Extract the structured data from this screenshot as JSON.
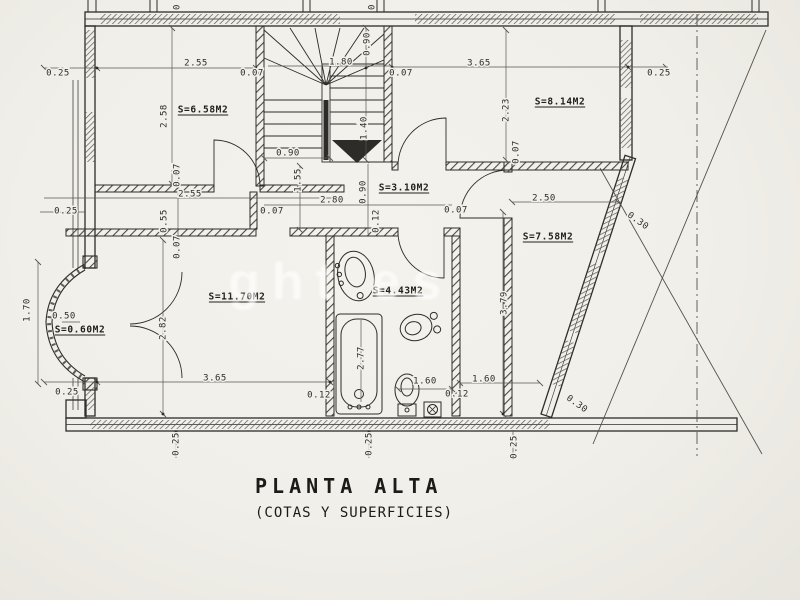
{
  "document": {
    "title": "PLANTA ALTA",
    "subtitle": "(COTAS Y SUPERFICIES)",
    "watermark_text": "ght es"
  },
  "colors": {
    "paper": "#f2f0ea",
    "ink": "#2e2c28",
    "dim_line": "#5a5751",
    "watermark": "#ffffff"
  },
  "room_area_labels": [
    "S=6.58M2",
    "S=8.14M2",
    "S=3.10M2",
    "S=7.58M2",
    "S=11.70M2",
    "S=4.43M2",
    "S=0.60M2"
  ],
  "plan": {
    "labels": [
      {
        "t": "0.25",
        "x": 58,
        "y": 73
      },
      {
        "t": "2.55",
        "x": 196,
        "y": 63
      },
      {
        "t": "0.07",
        "x": 252,
        "y": 73
      },
      {
        "t": "1.80",
        "x": 341,
        "y": 62
      },
      {
        "t": "0.90",
        "x": 367,
        "y": 44,
        "r": -90
      },
      {
        "t": "1.40",
        "x": 364,
        "y": 128,
        "r": -90
      },
      {
        "t": "0.07",
        "x": 401,
        "y": 73
      },
      {
        "t": "3.65",
        "x": 479,
        "y": 63
      },
      {
        "t": "0.25",
        "x": 659,
        "y": 73
      },
      {
        "t": "S=6.58M2",
        "x": 203,
        "y": 110,
        "u": 1
      },
      {
        "t": "2.58",
        "x": 164,
        "y": 116,
        "r": -90
      },
      {
        "t": "S=8.14M2",
        "x": 560,
        "y": 102,
        "u": 1
      },
      {
        "t": "2.23",
        "x": 506,
        "y": 110,
        "r": -90
      },
      {
        "t": "0.07",
        "x": 516,
        "y": 152,
        "r": -90
      },
      {
        "t": "0.90",
        "x": 288,
        "y": 153
      },
      {
        "t": "1.55",
        "x": 298,
        "y": 180,
        "r": -90
      },
      {
        "t": "S=3.10M2",
        "x": 404,
        "y": 188,
        "u": 1
      },
      {
        "t": "2.80",
        "x": 332,
        "y": 200
      },
      {
        "t": "0.90",
        "x": 363,
        "y": 192,
        "r": -90
      },
      {
        "t": "0.12",
        "x": 376,
        "y": 221,
        "r": -90
      },
      {
        "t": "0.07",
        "x": 456,
        "y": 210
      },
      {
        "t": "0.07",
        "x": 177,
        "y": 175,
        "r": -90
      },
      {
        "t": "2.55",
        "x": 190,
        "y": 194
      },
      {
        "t": "0.07",
        "x": 272,
        "y": 211
      },
      {
        "t": "0.55",
        "x": 164,
        "y": 221,
        "r": -90
      },
      {
        "t": "0.07",
        "x": 177,
        "y": 247,
        "r": -90
      },
      {
        "t": "0.25",
        "x": 66,
        "y": 211
      },
      {
        "t": "2.50",
        "x": 544,
        "y": 198
      },
      {
        "t": "0.30",
        "x": 638,
        "y": 221,
        "r": 35
      },
      {
        "t": "S=7.58M2",
        "x": 548,
        "y": 237,
        "u": 1
      },
      {
        "t": "1.70",
        "x": 27,
        "y": 310,
        "r": -90
      },
      {
        "t": "0.50",
        "x": 64,
        "y": 316
      },
      {
        "t": "S=0.60M2",
        "x": 80,
        "y": 330,
        "u": 1
      },
      {
        "t": "2.82",
        "x": 163,
        "y": 328,
        "r": -90
      },
      {
        "t": "S=11.70M2",
        "x": 237,
        "y": 297,
        "u": 1
      },
      {
        "t": "S=4.43M2",
        "x": 398,
        "y": 291,
        "u": 1
      },
      {
        "t": "2.77",
        "x": 361,
        "y": 358,
        "r": -90
      },
      {
        "t": "3.79",
        "x": 504,
        "y": 303,
        "r": -90
      },
      {
        "t": "3.65",
        "x": 215,
        "y": 378
      },
      {
        "t": "0.12",
        "x": 319,
        "y": 395
      },
      {
        "t": "1.60",
        "x": 425,
        "y": 381
      },
      {
        "t": "0.12",
        "x": 457,
        "y": 394
      },
      {
        "t": "1.60",
        "x": 484,
        "y": 379
      },
      {
        "t": "0.30",
        "x": 577,
        "y": 404,
        "r": 35
      },
      {
        "t": "0.25",
        "x": 67,
        "y": 392
      },
      {
        "t": "0.25",
        "x": 176,
        "y": 444,
        "r": -90
      },
      {
        "t": "0.25",
        "x": 369,
        "y": 444,
        "r": -90
      },
      {
        "t": "0.25",
        "x": 514,
        "y": 447,
        "r": -90
      },
      {
        "t": "0",
        "x": 177,
        "y": 7,
        "r": -90
      },
      {
        "t": "0",
        "x": 372,
        "y": 7,
        "r": -90
      }
    ]
  }
}
